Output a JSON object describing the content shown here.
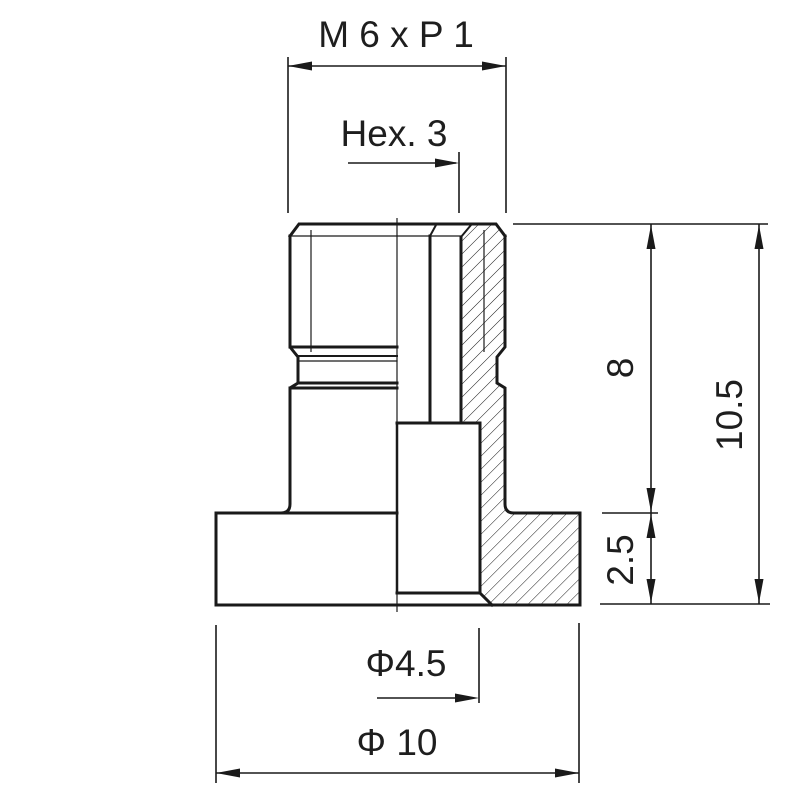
{
  "colors": {
    "background": "#ffffff",
    "line": "#1a1a1a",
    "text": "#1e1e1e"
  },
  "labels": {
    "thread_spec": "M 6 x P 1",
    "hex_socket": "Hex. 3",
    "shank_height": "8",
    "total_height": "10.5",
    "flange_height": "2.5",
    "hole_diameter": "Φ4.5",
    "flange_diameter": "Φ 10"
  }
}
